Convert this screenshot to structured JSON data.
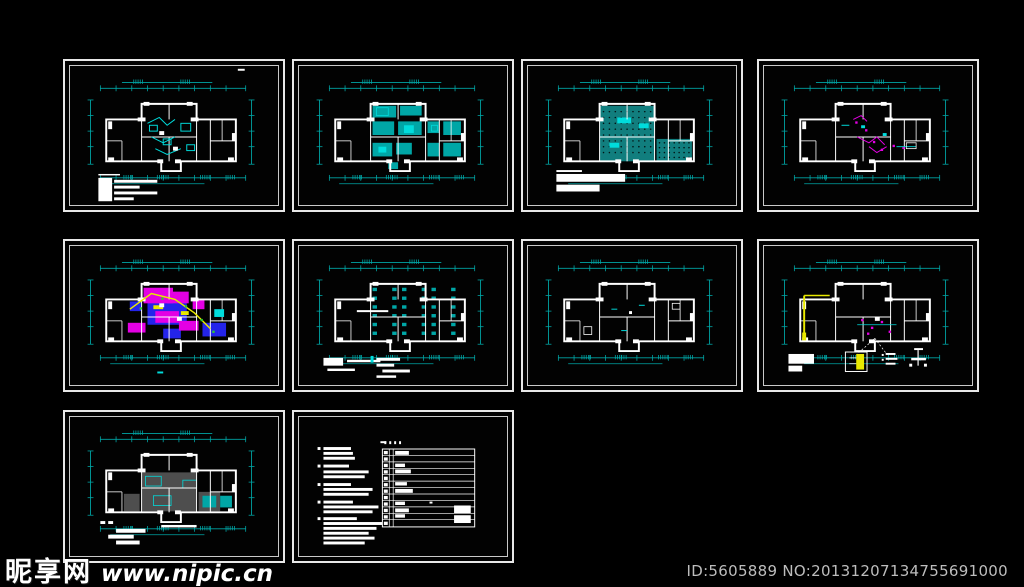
{
  "page": {
    "background": "#000000",
    "description": "CAD drawing package preview: ten framed architectural plan sheets on a black model-space background"
  },
  "watermark": {
    "site_name": "昵享网",
    "site_url": "www.nipic.cn",
    "id_text": "ID:5605889 NO:20131207134755691000"
  },
  "colors": {
    "cyan": "#00a6a6",
    "bright_cyan": "#00dcdc",
    "teal_fill": "#117e7e",
    "white": "#ffffff",
    "magenta": "#e400e4",
    "blue": "#2424ea",
    "yellow": "#e9e900",
    "green": "#2ecc2e",
    "gray_fill": "#4e4e4e",
    "frame_outer": "#e8e8e8",
    "frame_inner": "#c9c9c9",
    "id_text_color": "#bdbdbd"
  },
  "sheets": [
    {
      "id": "sheet-1",
      "row": 0,
      "col": 0,
      "kind": "plan",
      "variant": "v1",
      "has_legend": true
    },
    {
      "id": "sheet-2",
      "row": 0,
      "col": 1,
      "kind": "plan",
      "variant": "v2",
      "has_legend": false
    },
    {
      "id": "sheet-3",
      "row": 0,
      "col": 2,
      "kind": "plan",
      "variant": "v3",
      "has_legend": true
    },
    {
      "id": "sheet-4",
      "row": 0,
      "col": 3,
      "kind": "plan",
      "variant": "v4",
      "has_legend": false
    },
    {
      "id": "sheet-5",
      "row": 1,
      "col": 0,
      "kind": "plan",
      "variant": "v5",
      "has_legend": false
    },
    {
      "id": "sheet-6",
      "row": 1,
      "col": 1,
      "kind": "plan",
      "variant": "v6",
      "has_legend": true
    },
    {
      "id": "sheet-7",
      "row": 1,
      "col": 2,
      "kind": "plan",
      "variant": "v7",
      "has_legend": false
    },
    {
      "id": "sheet-8",
      "row": 1,
      "col": 3,
      "kind": "plan",
      "variant": "v8",
      "has_legend": true
    },
    {
      "id": "sheet-9",
      "row": 2,
      "col": 0,
      "kind": "plan",
      "variant": "v9",
      "has_legend": true
    },
    {
      "id": "sheet-10",
      "row": 2,
      "col": 1,
      "kind": "notes",
      "variant": "v10",
      "has_legend": false
    }
  ]
}
